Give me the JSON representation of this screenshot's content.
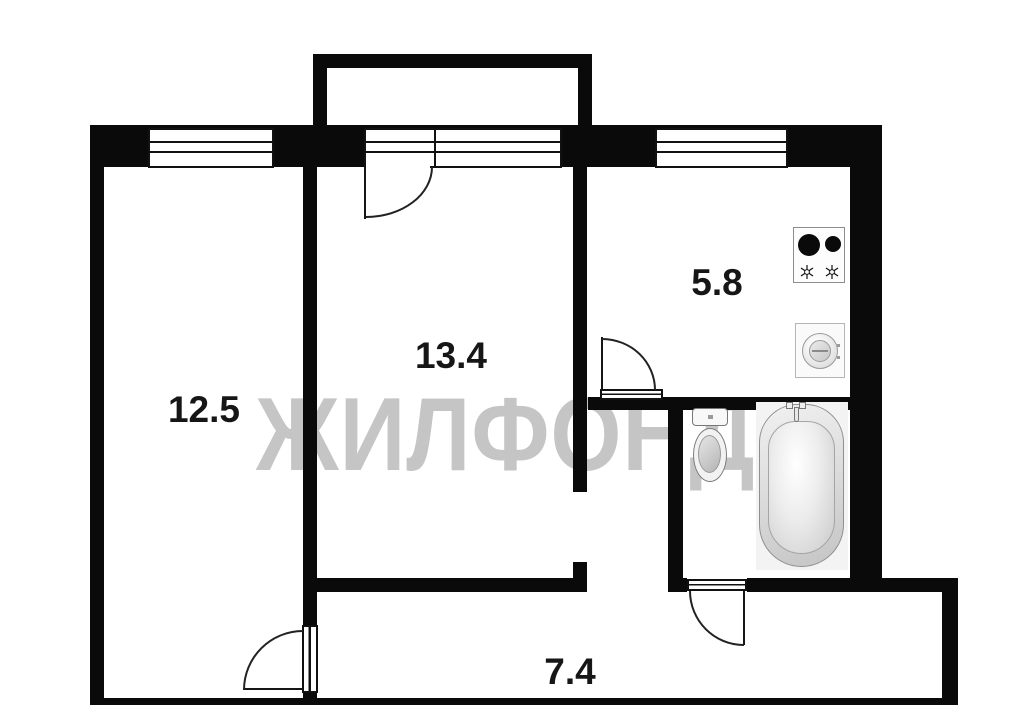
{
  "plan": {
    "type": "apartment-floor-plan",
    "watermark": {
      "text": "ЖИЛФОНД",
      "color": "#c5c5c5"
    },
    "colors": {
      "wall": "#0a0a0a",
      "label_text": "#161616",
      "background": "#ffffff"
    },
    "rooms": [
      {
        "id": "living-room-left",
        "area_label": "12.5"
      },
      {
        "id": "living-room-center",
        "area_label": "13.4"
      },
      {
        "id": "kitchen",
        "area_label": "5.8"
      },
      {
        "id": "hallway",
        "area_label": "7.4"
      }
    ],
    "fixtures": [
      {
        "icon": "stove-icon",
        "room": "kitchen"
      },
      {
        "icon": "washing-machine-icon",
        "room": "kitchen"
      },
      {
        "icon": "toilet-icon",
        "room": "bathroom"
      },
      {
        "icon": "bathtub-icon",
        "room": "bathroom"
      }
    ],
    "features": [
      "balcony",
      "balcony-door",
      "three-windows",
      "four-door-swings"
    ]
  }
}
